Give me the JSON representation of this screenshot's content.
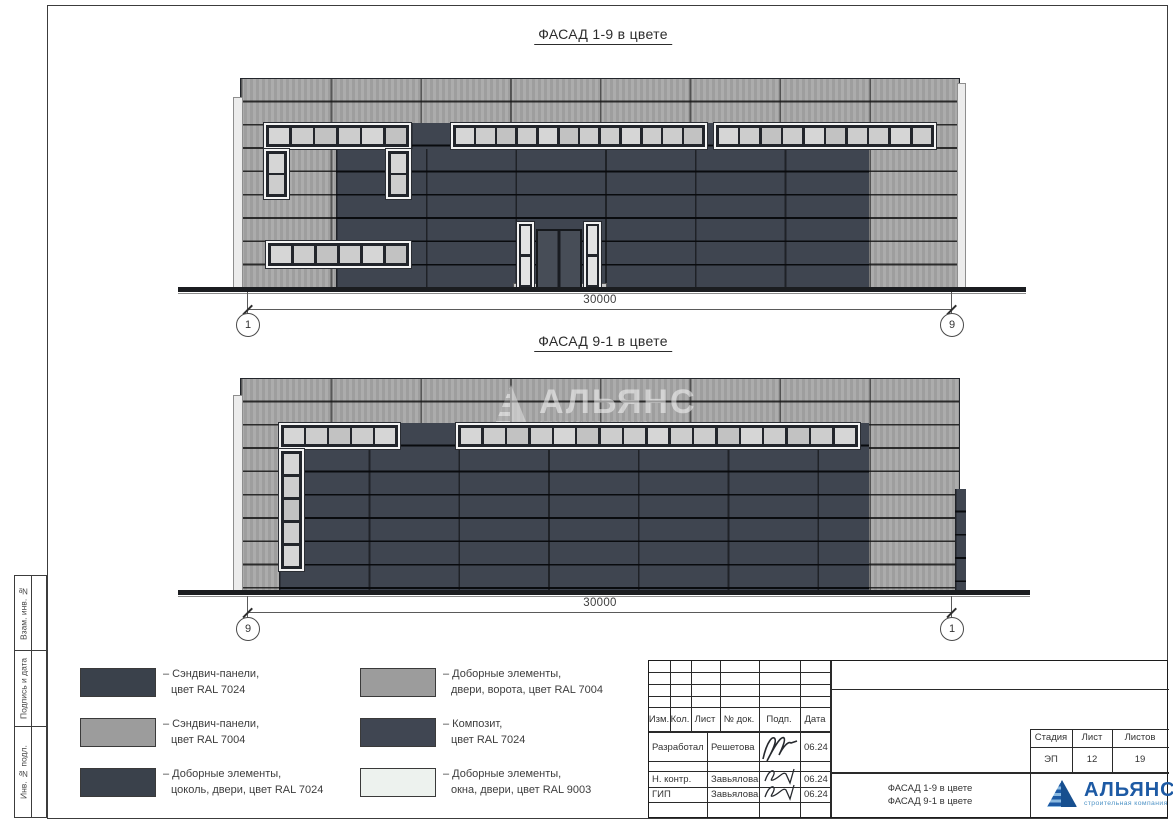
{
  "sheet": {
    "facade_top": {
      "title": "ФАСАД 1-9 в цвете",
      "dimension": "30000",
      "axis_left": "1",
      "axis_right": "9"
    },
    "facade_bottom": {
      "title": "ФАСАД 9-1 в цвете",
      "dimension": "30000",
      "axis_left": "9",
      "axis_right": "1"
    },
    "watermark": {
      "brand": "АЛЬЯНС",
      "subtitle": "строительная компания"
    },
    "legend": {
      "items": [
        {
          "swatch": "#3a414b",
          "line1": "– Сэндвич-панели,",
          "line2": "цвет RAL 7024"
        },
        {
          "swatch": "#9c9c9c",
          "line1": "– Сэндвич-панели,",
          "line2": "цвет RAL 7004"
        },
        {
          "swatch": "#3a414b",
          "line1": "– Доборные элементы,",
          "line2": "цоколь, двери, цвет RAL 7024"
        },
        {
          "swatch": "#9c9c9c",
          "line1": "– Доборные элементы,",
          "line2": "двери, ворота, цвет RAL 7004"
        },
        {
          "swatch": "#404652",
          "line1": "– Композит,",
          "line2": "цвет RAL 7024"
        },
        {
          "swatch": "#edf2ee",
          "line1": "– Доборные элементы,",
          "line2": "окна, двери, цвет RAL 9003"
        }
      ]
    },
    "titleblock": {
      "cols": {
        "izm": "Изм.",
        "kol": "Кол.",
        "list": "Лист",
        "doc": "№ док.",
        "podp": "Подп.",
        "data": "Дата"
      },
      "rows": [
        {
          "role": "Разработал",
          "name": "Решетова",
          "date": "06.24"
        },
        {
          "role": "Н. контр.",
          "name": "Завьялова",
          "date": "06.24"
        },
        {
          "role": "ГИП",
          "name": "Завьялова",
          "date": "06.24"
        }
      ],
      "stage_label": "Стадия",
      "sheet_label": "Лист",
      "sheets_label": "Листов",
      "stage": "ЭП",
      "sheet_num": "12",
      "sheets_total": "19",
      "doc_title1": "ФАСАД 1-9 в цвете",
      "doc_title2": "ФАСАД 9-1 в цвете",
      "logo": {
        "brand": "АЛЬЯНС",
        "subtitle": "строительная компания"
      }
    },
    "margin_labels": [
      "Взам. инв. №",
      "Подпись и дата",
      "Инв. № подл."
    ]
  },
  "colors": {
    "panel_light": "#a7a7a7",
    "panel_dark": "#3f4550",
    "window_glass": "#cdcdcd",
    "window_frame": "#f4f4f4",
    "logo_blue": "#1d5aa4",
    "logo_light": "#8ab9e0",
    "logo_deep": "#174f8f"
  }
}
